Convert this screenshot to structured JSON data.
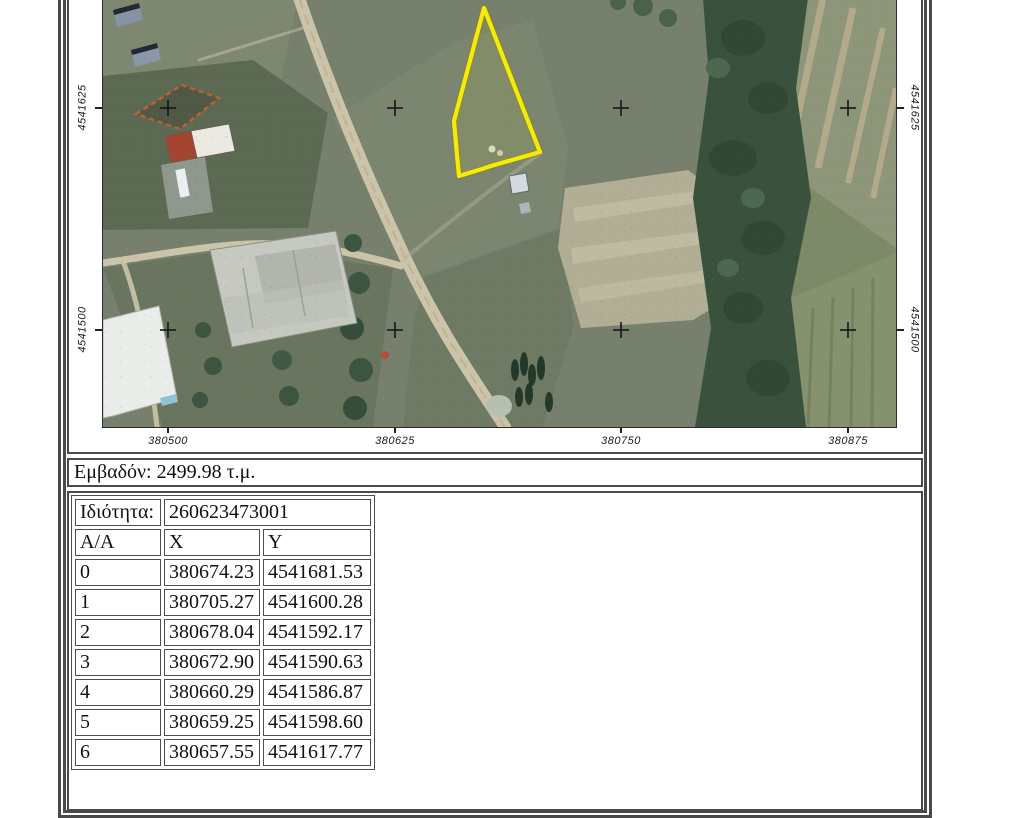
{
  "map": {
    "x_axis_ticks": [
      {
        "label": "380500",
        "x": 65
      },
      {
        "label": "380625",
        "x": 292
      },
      {
        "label": "380750",
        "x": 518
      },
      {
        "label": "380875",
        "x": 745
      }
    ],
    "y_axis_ticks": [
      {
        "label": "4541625",
        "y": 110
      },
      {
        "label": "4541500",
        "y": 332
      }
    ],
    "grid_cross_xs": [
      65,
      292,
      518,
      745
    ],
    "grid_cross_ys": [
      110,
      332
    ],
    "parcel_outline": {
      "color": "#f5eb0a",
      "points_px": [
        [
          381,
          10
        ],
        [
          437,
          154
        ],
        [
          388,
          168
        ],
        [
          379,
          171
        ],
        [
          356,
          178
        ],
        [
          354,
          157
        ],
        [
          351,
          123
        ]
      ]
    }
  },
  "area_summary": {
    "text": "Εμβαδόν: 2499.98 τ.μ."
  },
  "property": {
    "label": "Ιδιότητα:",
    "value": "260623473001"
  },
  "coords_table": {
    "headers": [
      "Α/Α",
      "X",
      "Y"
    ],
    "rows": [
      [
        "0",
        "380674.23",
        "4541681.53"
      ],
      [
        "1",
        "380705.27",
        "4541600.28"
      ],
      [
        "2",
        "380678.04",
        "4541592.17"
      ],
      [
        "3",
        "380672.90",
        "4541590.63"
      ],
      [
        "4",
        "380660.29",
        "4541586.87"
      ],
      [
        "5",
        "380659.25",
        "4541598.60"
      ],
      [
        "6",
        "380657.55",
        "4541617.77"
      ]
    ]
  }
}
